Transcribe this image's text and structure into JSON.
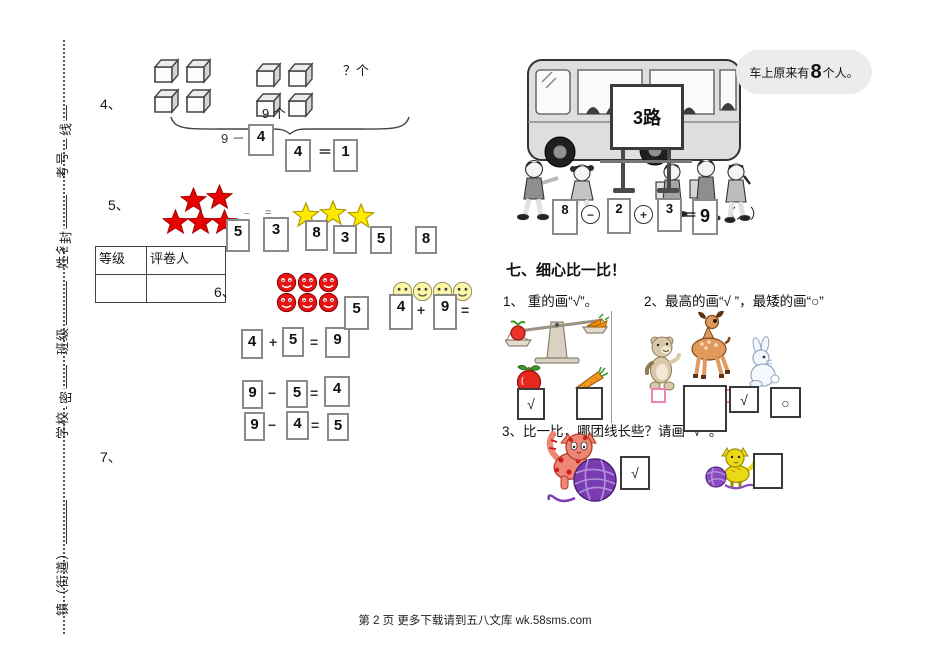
{
  "page": {
    "footer": "第 2 页 更多下载请到五八文库 wk.58sms.com"
  },
  "margin": {
    "labels": [
      "考号",
      "姓名",
      "班级",
      "学校",
      "镇（街道）"
    ],
    "seal_chars": [
      "线",
      "封",
      "密"
    ]
  },
  "grading_table": {
    "col1": "等级",
    "col2": "评卷人"
  },
  "q4": {
    "label": "4、",
    "question_count": "？个",
    "group_count": "9 个",
    "minuend": "9 －",
    "box_a": "4",
    "box_b": "4",
    "equals": "＝",
    "box_c": "1",
    "cubes_left": 4,
    "cubes_right": 4
  },
  "q5": {
    "label": "5、",
    "red_stars": 5,
    "yellow_stars": 3,
    "minus_mark": "−",
    "equals_mark": "=",
    "boxes": [
      "5",
      "3",
      "8",
      "3",
      "5",
      "8"
    ]
  },
  "q6": {
    "label": "6、",
    "red_smileys": 6,
    "yellow_smileys": 4,
    "float_box": "5",
    "top": {
      "a": "4",
      "plus": "+",
      "b": "9",
      "equals": "="
    },
    "rows": [
      {
        "a": "4",
        "op": "+",
        "b": "5",
        "equals": "=",
        "c": "9"
      },
      {
        "a": "9",
        "op": "−",
        "b": "5",
        "equals": "=",
        "c": "4"
      },
      {
        "a": "9",
        "op": "−",
        "b": "4",
        "equals": "=",
        "c": "5"
      }
    ]
  },
  "q7": {
    "label": "7、"
  },
  "bus": {
    "sign": "3路",
    "bubble": {
      "prefix": "车上原来有",
      "number": "8",
      "suffix": "个人。"
    },
    "equation": {
      "a": "8",
      "minus": "−",
      "b": "2",
      "plus": "+",
      "c": "3",
      "equals": "＝",
      "result": "9",
      "unit": "（人）"
    }
  },
  "section7": {
    "heading": "七、细心比一比！",
    "q1_label": "1、 重的画“√”。",
    "q2_label": "2、最高的画“√ ”，最矮的画“○”",
    "q3_label": "3、比一比，哪团线长些？请画“ √ ”。",
    "q1_boxes": [
      "√",
      ""
    ],
    "q2_boxes": [
      "",
      "√",
      "○"
    ],
    "q3_boxes": [
      "√",
      ""
    ]
  }
}
